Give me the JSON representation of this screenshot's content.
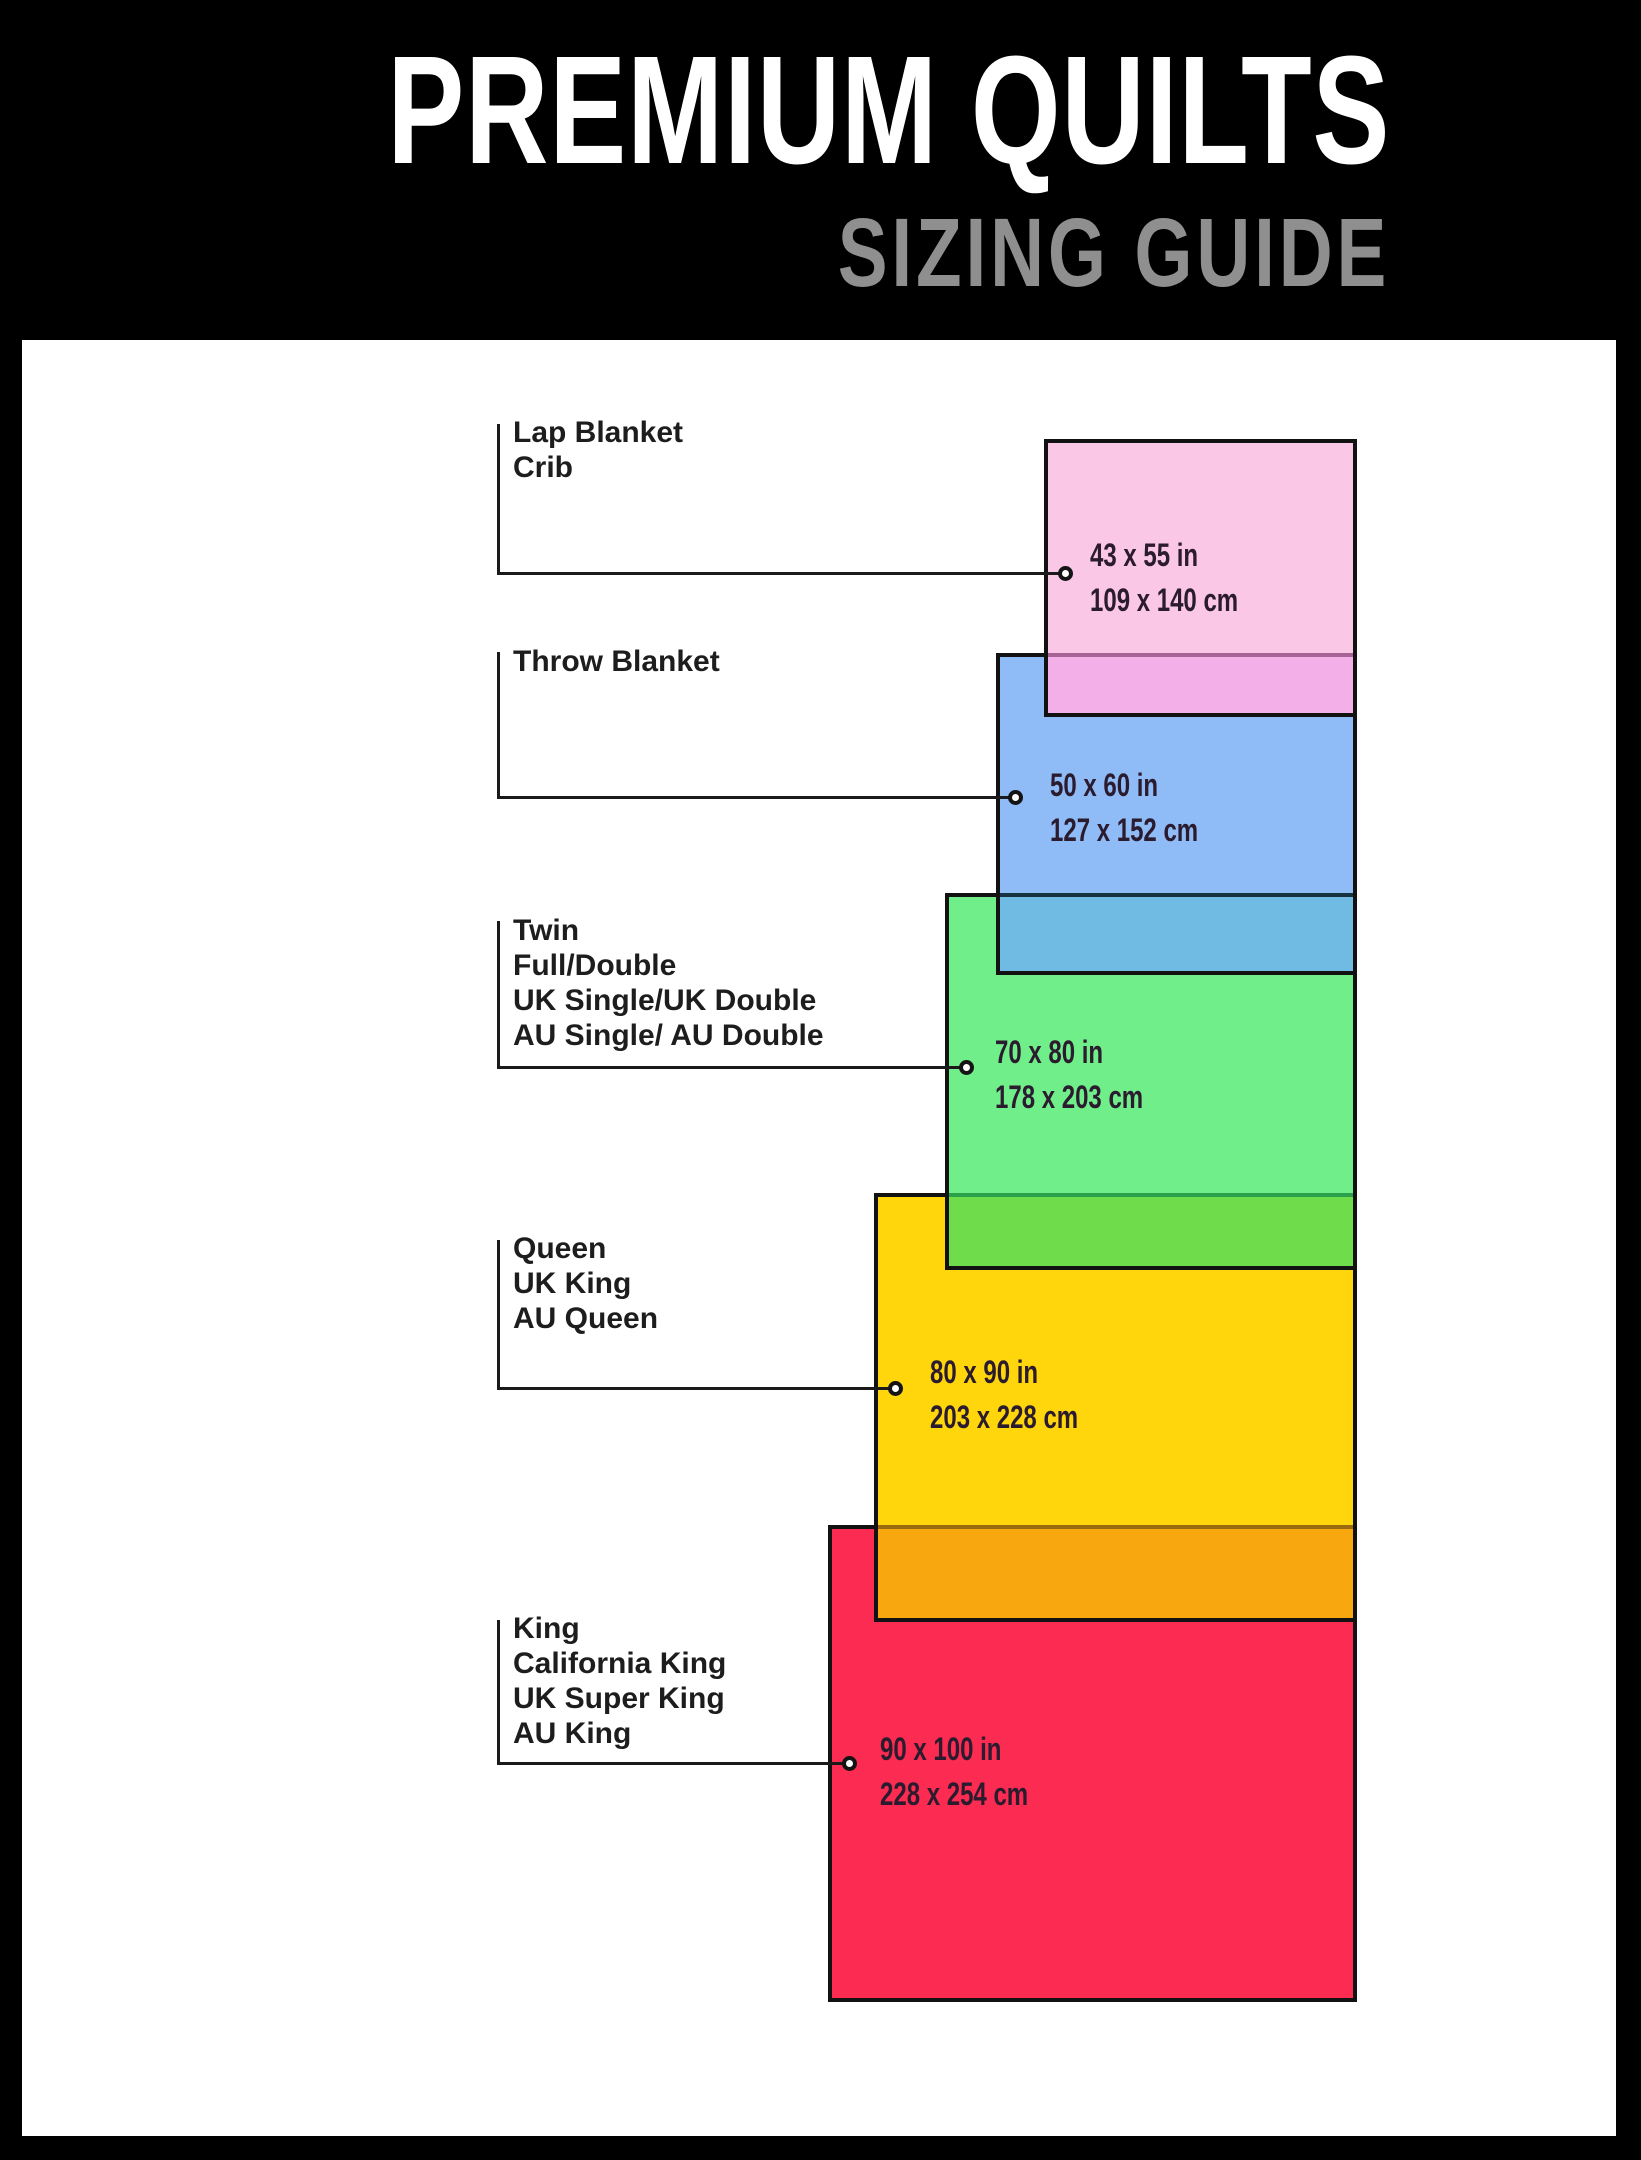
{
  "header": {
    "title": "PREMIUM QUILTS",
    "subtitle": "SIZING GUIDE"
  },
  "colors": {
    "page_bg": "#000000",
    "panel_bg": "#ffffff",
    "title": "#ffffff",
    "subtitle": "#8f8f8f",
    "rect_border": "#121212",
    "connector_line": "#1a1a1a",
    "label_text": "#1d1d1d",
    "dims_text": "#2b1b2e"
  },
  "groups": [
    {
      "names": [
        "Lap Blanket",
        "Crib"
      ],
      "inches": "43 x 55 in",
      "cm": "109 x 140 cm",
      "fill": "#fbc7e6",
      "overlap_fill": "#f3afe8",
      "overlap_line": "#a86396"
    },
    {
      "names": [
        "Throw Blanket"
      ],
      "inches": "50 x 60 in",
      "cm": "127 x 152 cm",
      "fill": "#8fbcf7",
      "overlap_fill": "#6fbbe4",
      "overlap_line": "#16333f"
    },
    {
      "names": [
        "Twin",
        "Full/Double",
        "UK Single/UK Double",
        "AU Single/ AU Double"
      ],
      "inches": "70 x 80 in",
      "cm": "178 x 203 cm",
      "fill": "#70ee8a",
      "overlap_fill": "#6edc4b",
      "overlap_line": "#2ba04a"
    },
    {
      "names": [
        "Queen",
        "UK King",
        "AU Queen"
      ],
      "inches": "80 x 90 in",
      "cm": "203 x 228 cm",
      "fill": "#ffd60b",
      "overlap_fill": "#f9a70e",
      "overlap_line": "#9a6a10"
    },
    {
      "names": [
        "King",
        "California King",
        "UK Super King",
        "AU King"
      ],
      "inches": "90 x 100 in",
      "cm": "228 x 254 cm",
      "fill": "#fb2b51",
      "overlap_fill": null,
      "overlap_line": null
    }
  ]
}
